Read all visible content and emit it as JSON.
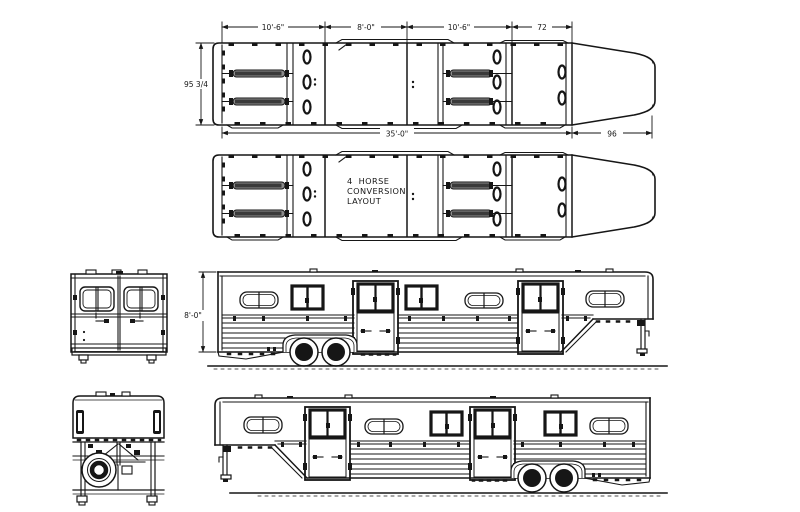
{
  "page": {
    "background": "#ffffff",
    "line_color": "#161616",
    "divider_fill": "#8c8c8c",
    "subject": "4 horse gooseneck trailer blueprint, plan and elevation views"
  },
  "plan": {
    "bay1": "10'-6\"",
    "dress": "8'-0\"",
    "bay2": "10'-6\"",
    "front": "72",
    "width": "95 3/4",
    "length": "35'-0\"",
    "gooseneck": "96"
  },
  "layout_note": {
    "l1": "4  HORSE",
    "l2": "CONVERSION",
    "l3": "LAYOUT"
  },
  "elevation": {
    "height": "8'-0\""
  }
}
